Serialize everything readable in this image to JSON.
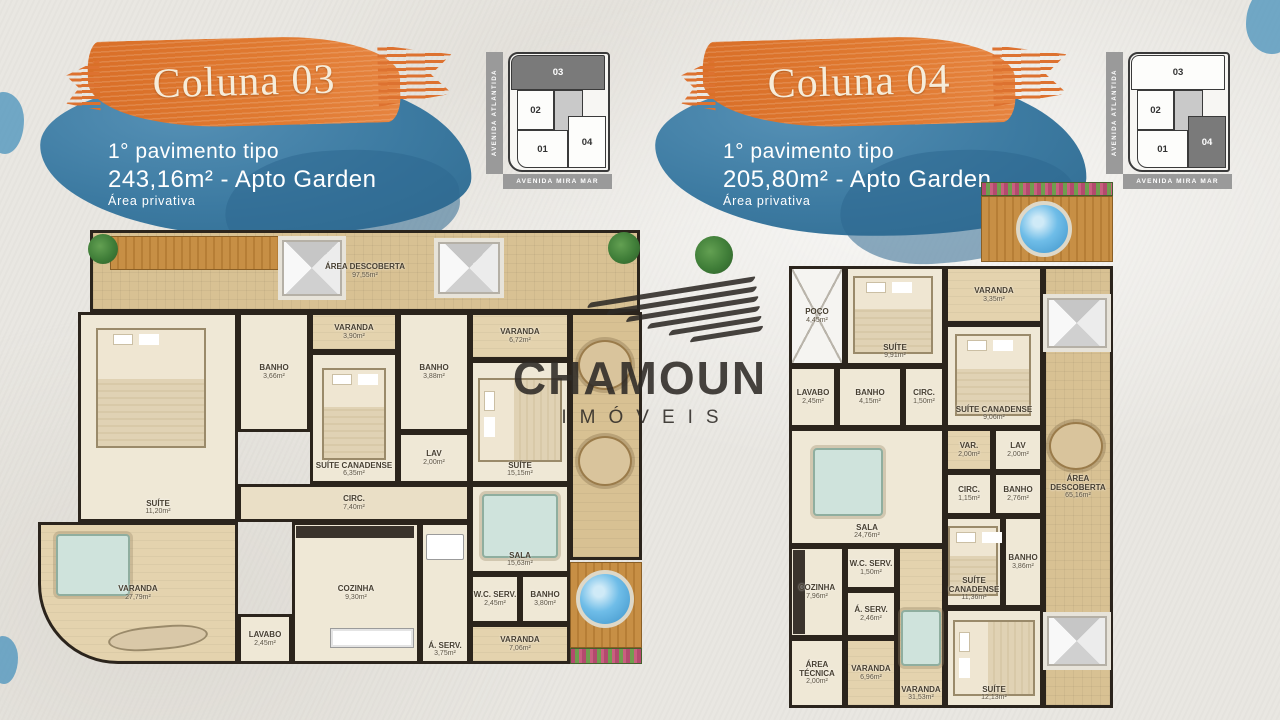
{
  "watermark": {
    "title": "CHAMOUN",
    "subtitle": "IMÓVEIS"
  },
  "colors": {
    "accent_orange": "#DD7230",
    "brush_blue": "#3F80A8",
    "title_cream": "#F6ECD9",
    "plan_wall": "#2B241C",
    "plan_floor": "#EFE8D6",
    "plan_terrace": "#D8C193",
    "pool_blue": "#4FA8DC",
    "map_gray": "#9A9A9A",
    "map_highlight": "#7A7A7A"
  },
  "columns": [
    {
      "title": "Coluna 03",
      "subtitle_line1": "1° pavimento tipo",
      "subtitle_line2": "243,16m² - Apto Garden",
      "subtitle_line3": "Área privativa",
      "map": {
        "street_left": "AVENIDA ATLÂNTIDA",
        "street_bottom": "AVENIDA MIRA MAR",
        "units": [
          "01",
          "02",
          "03",
          "04"
        ],
        "highlighted_unit": "03"
      },
      "rooms": [
        {
          "name": "ÁREA DESCOBERTA",
          "area": "97,55m²"
        },
        {
          "name": "SUÍTE",
          "area": "11,20m²"
        },
        {
          "name": "BANHO",
          "area": "3,66m²"
        },
        {
          "name": "VARANDA",
          "area": "3,90m²"
        },
        {
          "name": "SUÍTE CANADENSE",
          "area": "6,35m²"
        },
        {
          "name": "BANHO",
          "area": "3,88m²"
        },
        {
          "name": "LAV",
          "area": "2,00m²"
        },
        {
          "name": "VARANDA",
          "area": "6,72m²"
        },
        {
          "name": "SUÍTE",
          "area": "15,15m²"
        },
        {
          "name": "CIRC.",
          "area": "7,40m²"
        },
        {
          "name": "SALA",
          "area": "15,63m²"
        },
        {
          "name": "VARANDA",
          "area": "27,79m²"
        },
        {
          "name": "LAVABO",
          "area": "2,45m²"
        },
        {
          "name": "COZINHA",
          "area": "9,30m²"
        },
        {
          "name": "Á. SERV.",
          "area": "3,75m²"
        },
        {
          "name": "W.C. SERV.",
          "area": "2,45m²"
        },
        {
          "name": "BANHO",
          "area": "3,80m²"
        },
        {
          "name": "VARANDA",
          "area": "7,06m²"
        }
      ]
    },
    {
      "title": "Coluna 04",
      "subtitle_line1": "1° pavimento tipo",
      "subtitle_line2": "205,80m² - Apto Garden",
      "subtitle_line3": "Área privativa",
      "map": {
        "street_left": "AVENIDA ATLÂNTIDA",
        "street_bottom": "AVENIDA MIRA MAR",
        "units": [
          "01",
          "02",
          "03",
          "04"
        ],
        "highlighted_unit": "04"
      },
      "rooms": [
        {
          "name": "ÁREA DESCOBERTA",
          "area": "65,16m²"
        },
        {
          "name": "POÇO",
          "area": "4,45m²"
        },
        {
          "name": "SUÍTE",
          "area": "9,91m²"
        },
        {
          "name": "VARANDA",
          "area": "3,35m²"
        },
        {
          "name": "SUÍTE CANADENSE",
          "area": "9,06m²"
        },
        {
          "name": "LAVABO",
          "area": "2,45m²"
        },
        {
          "name": "BANHO",
          "area": "4,15m²"
        },
        {
          "name": "CIRC.",
          "area": "1,50m²"
        },
        {
          "name": "SALA",
          "area": "24,76m²"
        },
        {
          "name": "VAR.",
          "area": "2,00m²"
        },
        {
          "name": "LAV",
          "area": "2,00m²"
        },
        {
          "name": "CIRC.",
          "area": "1,15m²"
        },
        {
          "name": "BANHO",
          "area": "2,76m²"
        },
        {
          "name": "SUÍTE CANADENSE",
          "area": "11,36m²"
        },
        {
          "name": "BANHO",
          "area": "3,86m²"
        },
        {
          "name": "COZINHA",
          "area": "7,96m²"
        },
        {
          "name": "W.C. SERV.",
          "area": "1,50m²"
        },
        {
          "name": "Á. SERV.",
          "area": "2,46m²"
        },
        {
          "name": "ÁREA TÉCNICA",
          "area": "2,00m²"
        },
        {
          "name": "VARANDA",
          "area": "6,96m²"
        },
        {
          "name": "VARANDA",
          "area": "31,53m²"
        },
        {
          "name": "SUÍTE",
          "area": "12,13m²"
        }
      ]
    }
  ]
}
